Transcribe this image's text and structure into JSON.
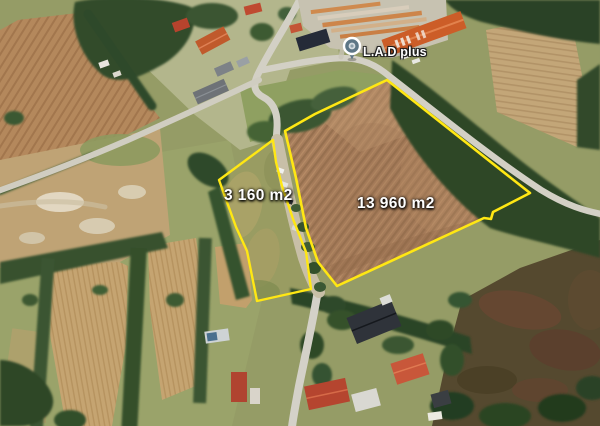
{
  "pin": {
    "label": "L.A.D plus",
    "icon": "map-pin-icon"
  },
  "parcels": [
    {
      "id": "small",
      "area_label": "3 160 m2"
    },
    {
      "id": "large",
      "area_label": "13 960 m2"
    }
  ],
  "colors": {
    "parcel-outline": "#ffe713",
    "label-text": "#ffffff",
    "pin-color": "#5d7686"
  }
}
